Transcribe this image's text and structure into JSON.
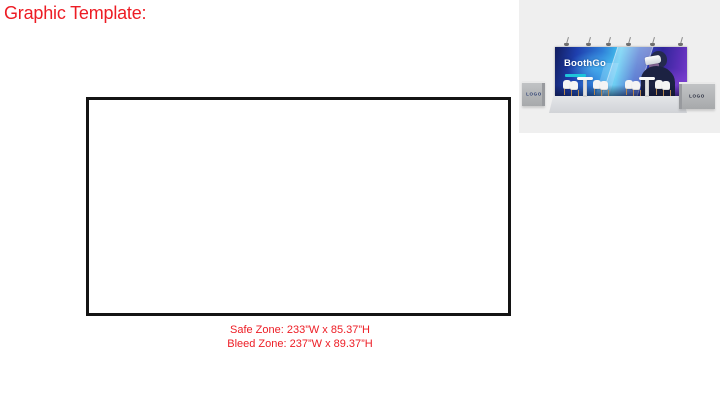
{
  "page": {
    "title": "Graphic Template:",
    "accent_color": "#ED1C24",
    "background_color": "#FFFFFF"
  },
  "template_canvas": {
    "border_color": "#141414",
    "fill_color": "#FFFFFF",
    "safe_zone_label": "Safe Zone: 233”W x 85.37”H",
    "bleed_zone_label": "Bleed Zone: 237”W x 89.37”H"
  },
  "booth_preview": {
    "background_color": "#EFEFEF",
    "spotlight_count": 6,
    "banner": {
      "brand": "BoothGo",
      "brand_color": "#FFFFFF",
      "tagline_color": "#1FC4DA"
    },
    "left_counter_label": "LOGO",
    "right_counter_label": "LOGO"
  },
  "icons": {
    "spotlight-icon": "css-lamp-shape",
    "vr-headset-icon": "css-rounded-rect"
  }
}
